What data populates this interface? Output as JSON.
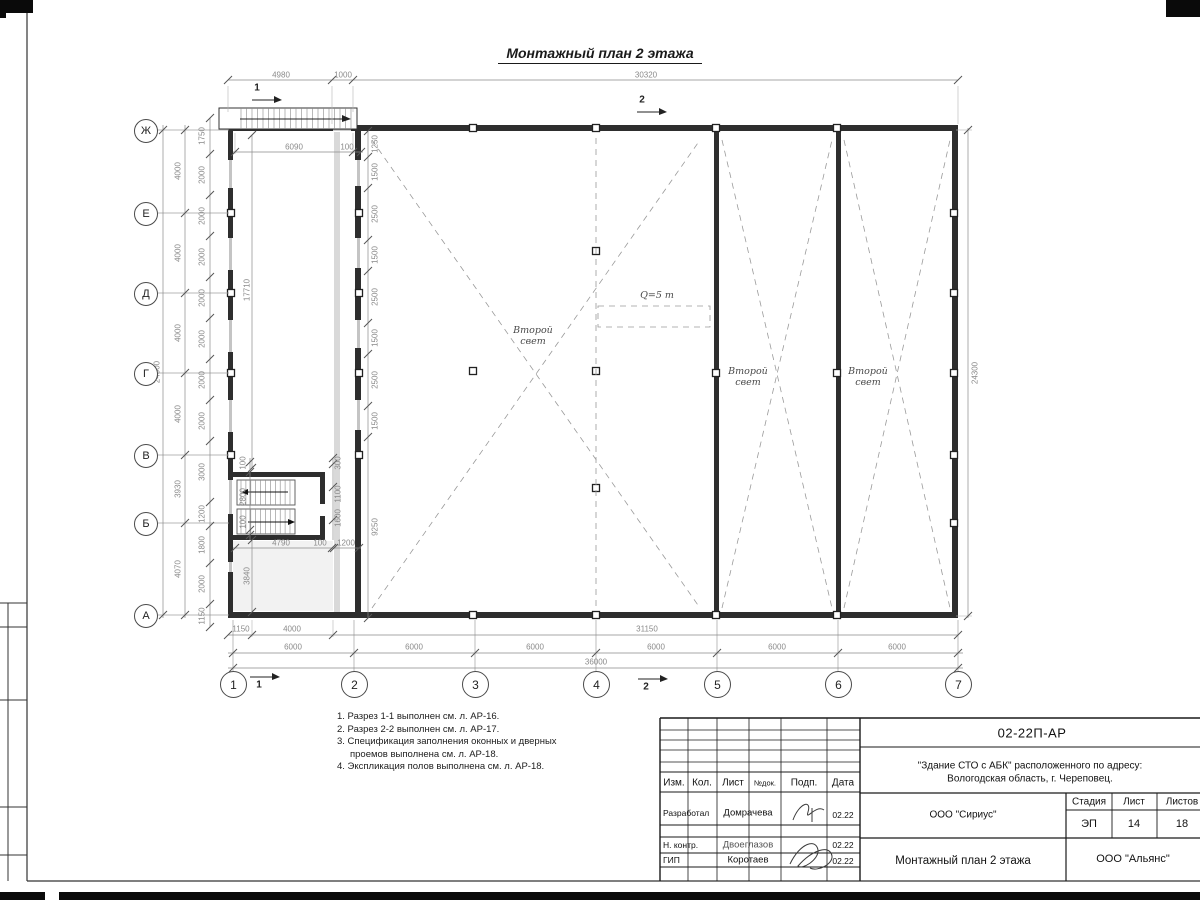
{
  "drawing": {
    "title": "Монтажный план 2 этажа",
    "labels": {
      "second_light": "Второй свет",
      "crane_capacity": "Q=5 т"
    },
    "section_marks": {
      "s1": "1",
      "s2": "2"
    },
    "row_axes": [
      "Ж",
      "Е",
      "Д",
      "Г",
      "В",
      "Б",
      "А"
    ],
    "col_axes": [
      "1",
      "2",
      "3",
      "4",
      "5",
      "6",
      "7"
    ],
    "dims": {
      "top_4980": "4980",
      "top_1000": "1000",
      "top_30320": "30320",
      "annex_6090": "6090",
      "annex_100": "100",
      "annex_17710": "17710",
      "annex_3840": "3840",
      "wall_chain": [
        "1250",
        "1500",
        "2500",
        "1500",
        "2500",
        "1500",
        "2500",
        "1500",
        "9250"
      ],
      "left_inner": [
        "1750",
        "2000",
        "2000",
        "2000",
        "2000",
        "2000",
        "2000",
        "2000",
        "3000",
        "1200",
        "1800",
        "2000",
        "1150"
      ],
      "left_mid": [
        "4000",
        "4000",
        "4000",
        "4000",
        "3930",
        "4070"
      ],
      "left_outer": "24000",
      "right_24300": "24300",
      "stair_left": [
        "100",
        "2800",
        "100"
      ],
      "stair_right": [
        "300",
        "1100",
        "1600"
      ],
      "stair_bottom": [
        "4790",
        "100",
        "1200"
      ],
      "bottom_chain1": [
        "1150",
        "4000",
        "31150"
      ],
      "bottom_6000": [
        "6000",
        "6000",
        "6000",
        "6000",
        "6000",
        "6000"
      ],
      "bottom_total": "36000"
    },
    "notes": [
      "1. Разрез 1-1 выполнен см. л. АР-16.",
      "2. Разрез 2-2 выполнен см. л. АР-17.",
      "3. Спецификация заполнения оконных и дверных проемов выполнена см. л. АР-18.",
      "4. Экспликация полов выполнена см. л. АР-18."
    ]
  },
  "title_block": {
    "doc_code": "02-22П-АР",
    "object_line1": "\"Здание СТО с АБК\" расположенного по адресу:",
    "object_line2": "Вологодская область, г. Череповец.",
    "columns": [
      "Изм.",
      "Кол.",
      "Лист",
      "№док.",
      "Подп.",
      "Дата"
    ],
    "signature_rows": [
      {
        "role": "Разработал",
        "name": "Домрачева",
        "date": "02.22"
      },
      {
        "role": "Н. контр.",
        "name": "Двоеглазов",
        "date": "02.22"
      },
      {
        "role": "ГИП",
        "name": "Коротаев",
        "date": "02.22"
      }
    ],
    "designer_org": "ООО \"Сириус\"",
    "stage_label": "Стадия",
    "sheet_label": "Лист",
    "sheets_label": "Листов",
    "stage": "ЭП",
    "sheet_number": "14",
    "sheets_total": "18",
    "sheet_title": "Монтажный план 2 этажа",
    "contractor_org": "ООО \"Альянс\""
  }
}
